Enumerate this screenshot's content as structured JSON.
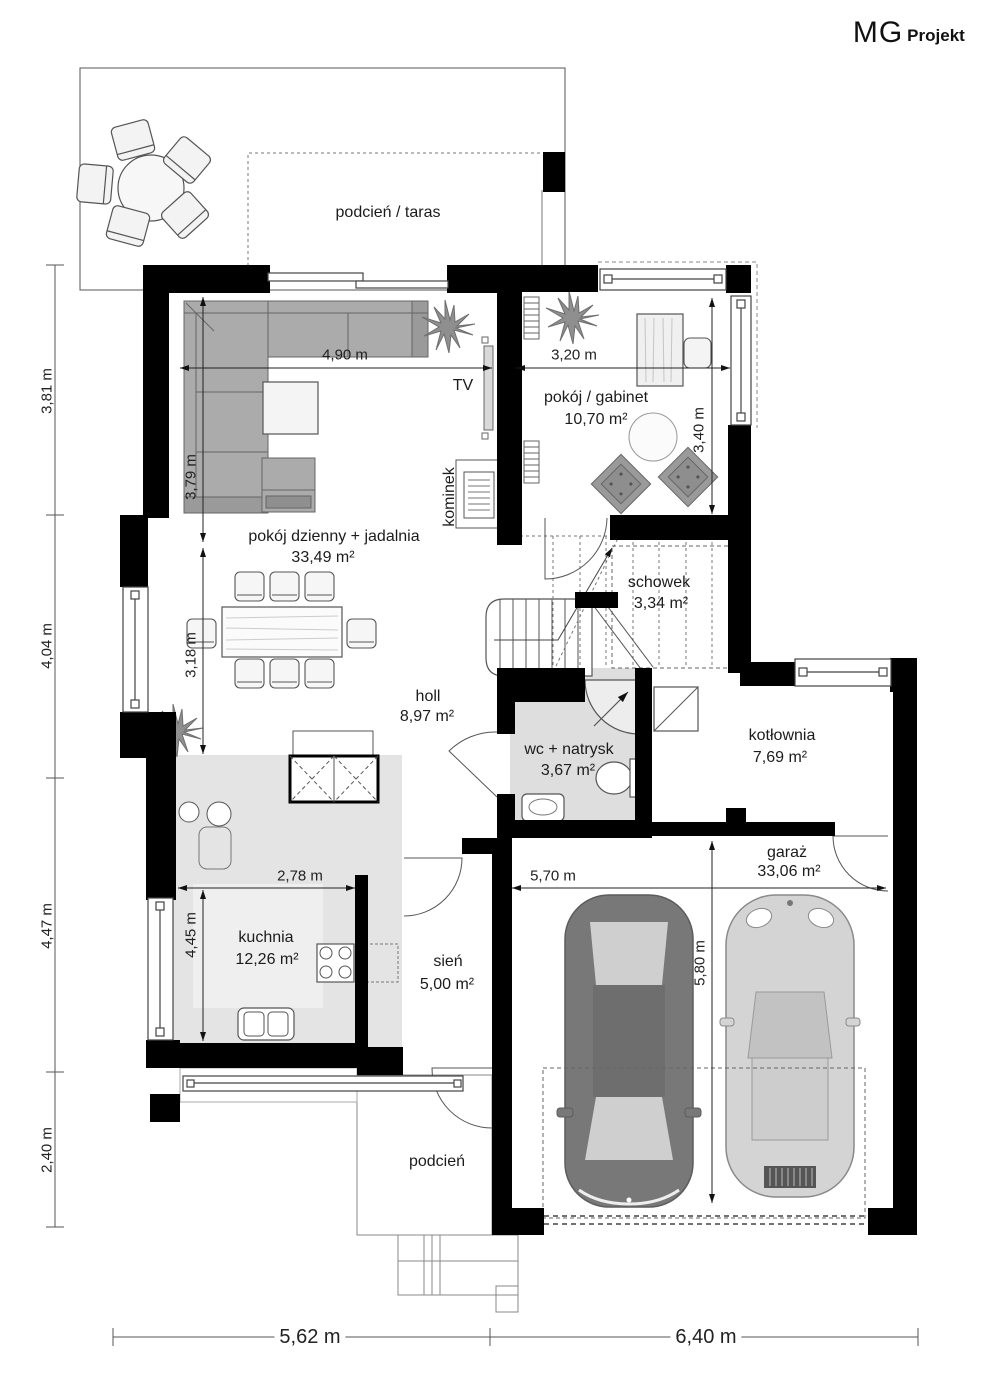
{
  "brand": {
    "mg": "MG",
    "projekt": "Projekt"
  },
  "rooms": {
    "taras": {
      "name": "podcień / taras"
    },
    "gabinet": {
      "name": "pokój / gabinet",
      "area": "10,70 m²"
    },
    "dzienny": {
      "name": "pokój dzienny + jadalnia",
      "area": "33,49 m²"
    },
    "schowek": {
      "name": "schowek",
      "area": "3,34 m²"
    },
    "holl": {
      "name": "holl",
      "area": "8,97 m²"
    },
    "wc": {
      "name": "wc + natrysk",
      "area": "3,67 m²"
    },
    "kotlownia": {
      "name": "kotłownia",
      "area": "7,69 m²"
    },
    "garaz": {
      "name": "garaż",
      "area": "33,06 m²"
    },
    "kuchnia": {
      "name": "kuchnia",
      "area": "12,26 m²"
    },
    "sien": {
      "name": "sień",
      "area": "5,00 m²"
    },
    "podcien": {
      "name": "podcień"
    }
  },
  "fixtures": {
    "tv": "TV",
    "kominek": "kominek"
  },
  "dimensions": {
    "left": [
      "3,81 m",
      "4,04 m",
      "4,47 m",
      "2,40 m"
    ],
    "bottom": [
      "5,62 m",
      "6,40 m"
    ],
    "living_width": "4,90 m",
    "gabinet_width": "3,20 m",
    "gabinet_height": "3,40 m",
    "living_height_upper": "3,79 m",
    "living_height_lower": "3,18 m",
    "kuchnia_width": "2,78 m",
    "kuchnia_height": "4,45 m",
    "garaz_width": "5,70 m",
    "garaz_height": "5,80 m"
  },
  "colors": {
    "walls": "#000000",
    "kitchen_floor": "#e4e4e4",
    "wc_floor": "#dedede",
    "car_dark": "#787878",
    "car_light": "#d4d4d4"
  }
}
